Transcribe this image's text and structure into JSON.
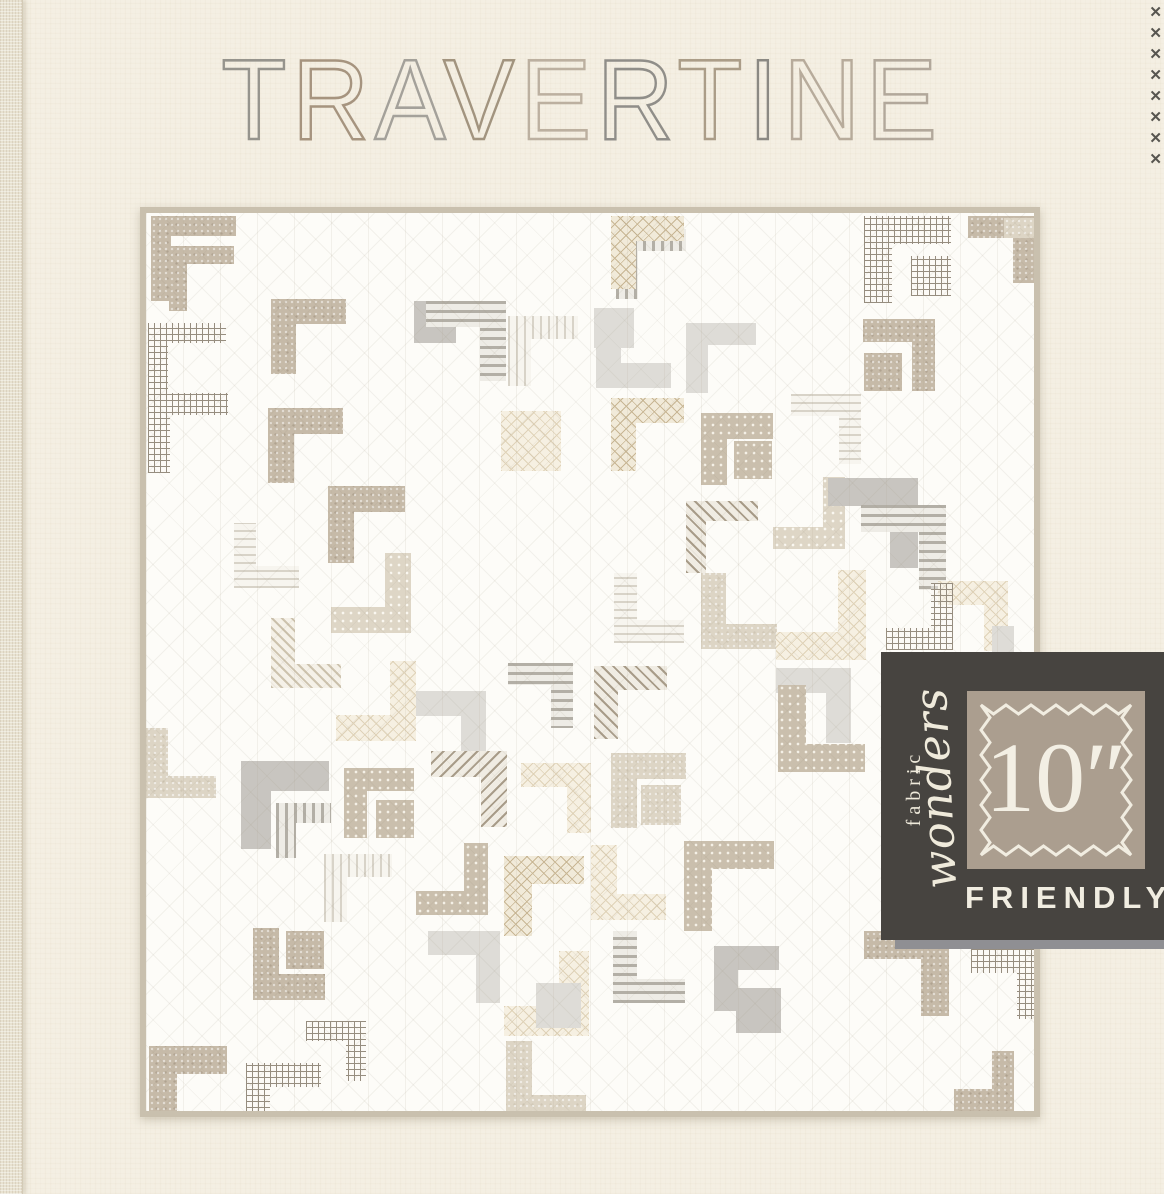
{
  "title": {
    "text": "TRAVERTINE",
    "letters": [
      {
        "ch": "T",
        "color": "#96948d"
      },
      {
        "ch": "R",
        "color": "#a6947f"
      },
      {
        "ch": "A",
        "color": "#a4a19a"
      },
      {
        "ch": "V",
        "color": "#a2947f"
      },
      {
        "ch": "E",
        "color": "#bcb0a0"
      },
      {
        "ch": "R",
        "color": "#908e89"
      },
      {
        "ch": "T",
        "color": "#ab9d88"
      },
      {
        "ch": "I",
        "color": "#8b8983"
      },
      {
        "ch": "N",
        "color": "#b7ab9b"
      },
      {
        "ch": "E",
        "color": "#b2a89b"
      }
    ]
  },
  "badge": {
    "brand_line1": "fabric",
    "brand_line2": "wonders",
    "size_label": "10″",
    "friendly_label": "FRIENDLY",
    "bg_color": "#474440",
    "stamp_color": "#ab9e8f",
    "text_color": "#f1ede1"
  },
  "decor": {
    "x_mark": "✕",
    "x_count": 8,
    "x_color": "#57554f"
  },
  "quilt": {
    "background": "#fdfcf8",
    "binding_color": "#c9c0ae",
    "block_shape": "L-corner",
    "blocks": [
      [
        5,
        3,
        85,
        20,
        0,
        "speckle"
      ],
      [
        23,
        33,
        65,
        18,
        0,
        "speckle"
      ],
      [
        2,
        110,
        78,
        20,
        0,
        "plaid"
      ],
      [
        2,
        180,
        80,
        22,
        0,
        "plaid"
      ],
      [
        122,
        195,
        75,
        26,
        0,
        "speckle"
      ],
      [
        125,
        86,
        75,
        25,
        0,
        "speckle"
      ],
      [
        362,
        103,
        70,
        23,
        0,
        "stripe-lt"
      ],
      [
        470,
        16,
        70,
        22,
        0,
        "stripe"
      ],
      [
        268,
        88,
        42,
        0,
        4,
        "gray"
      ],
      [
        280,
        88,
        80,
        26,
        1,
        "stripe"
      ],
      [
        355,
        198,
        60,
        0,
        4,
        "xhatch-lt"
      ],
      [
        465,
        3,
        73,
        25,
        0,
        "xhatch"
      ],
      [
        448,
        95,
        40,
        0,
        4,
        "gray-lt"
      ],
      [
        450,
        100,
        75,
        25,
        3,
        "gray-lt"
      ],
      [
        540,
        110,
        70,
        22,
        0,
        "gray-lt"
      ],
      [
        465,
        185,
        73,
        25,
        0,
        "xhatch"
      ],
      [
        555,
        200,
        72,
        26,
        0,
        "dots"
      ],
      [
        588,
        228,
        38,
        0,
        4,
        "dots"
      ],
      [
        645,
        181,
        70,
        22,
        1,
        "stripe-lt"
      ],
      [
        627,
        264,
        72,
        22,
        2,
        "dots-lt"
      ],
      [
        540,
        288,
        72,
        20,
        0,
        "diag"
      ],
      [
        718,
        3,
        87,
        28,
        0,
        "plaid"
      ],
      [
        765,
        43,
        40,
        0,
        4,
        "plaid"
      ],
      [
        822,
        3,
        67,
        22,
        1,
        "speckle"
      ],
      [
        717,
        106,
        72,
        23,
        1,
        "speckle"
      ],
      [
        718,
        140,
        38,
        0,
        4,
        "speckle"
      ],
      [
        682,
        265,
        90,
        28,
        1,
        "gray"
      ],
      [
        715,
        292,
        85,
        27,
        1,
        "stripe"
      ],
      [
        792,
        368,
        70,
        24,
        1,
        "xhatch-lt"
      ],
      [
        740,
        370,
        67,
        22,
        2,
        "plaid"
      ],
      [
        468,
        360,
        70,
        23,
        3,
        "stripe-lt"
      ],
      [
        555,
        360,
        76,
        25,
        3,
        "speckle-lt"
      ],
      [
        630,
        357,
        90,
        28,
        2,
        "xhatch-lt"
      ],
      [
        88,
        310,
        65,
        22,
        3,
        "stripe-lt"
      ],
      [
        125,
        405,
        70,
        24,
        3,
        "diag-lt"
      ],
      [
        182,
        273,
        77,
        26,
        0,
        "speckle"
      ],
      [
        185,
        340,
        80,
        26,
        2,
        "dots-lt"
      ],
      [
        0,
        515,
        70,
        22,
        3,
        "speckle-lt"
      ],
      [
        95,
        548,
        88,
        30,
        0,
        "gray"
      ],
      [
        130,
        590,
        55,
        20,
        0,
        "stripe"
      ],
      [
        198,
        555,
        70,
        23,
        0,
        "dots"
      ],
      [
        230,
        587,
        38,
        0,
        4,
        "dots"
      ],
      [
        268,
        478,
        72,
        25,
        1,
        "gray-lt"
      ],
      [
        285,
        538,
        76,
        26,
        1,
        "diag"
      ],
      [
        190,
        448,
        80,
        26,
        2,
        "xhatch-lt"
      ],
      [
        362,
        450,
        65,
        22,
        1,
        "stripe"
      ],
      [
        375,
        550,
        70,
        24,
        1,
        "xhatch-lt"
      ],
      [
        270,
        630,
        72,
        24,
        2,
        "dots"
      ],
      [
        178,
        641,
        68,
        23,
        0,
        "stripe-lt"
      ],
      [
        107,
        715,
        72,
        26,
        3,
        "speckle"
      ],
      [
        140,
        718,
        38,
        0,
        4,
        "speckle"
      ],
      [
        282,
        718,
        72,
        24,
        1,
        "gray-lt"
      ],
      [
        358,
        643,
        80,
        28,
        0,
        "xhatch"
      ],
      [
        358,
        738,
        85,
        30,
        2,
        "xhatch-lt"
      ],
      [
        390,
        770,
        45,
        0,
        4,
        "gray-lt"
      ],
      [
        360,
        828,
        80,
        26,
        3,
        "speckle-lt"
      ],
      [
        3,
        833,
        78,
        28,
        0,
        "speckle"
      ],
      [
        100,
        850,
        75,
        24,
        0,
        "plaid"
      ],
      [
        160,
        808,
        60,
        20,
        1,
        "plaid"
      ],
      [
        448,
        453,
        73,
        24,
        0,
        "diag"
      ],
      [
        465,
        540,
        75,
        26,
        0,
        "speckle-lt"
      ],
      [
        495,
        572,
        40,
        0,
        4,
        "speckle-lt"
      ],
      [
        445,
        632,
        75,
        26,
        3,
        "xhatch-lt"
      ],
      [
        538,
        628,
        90,
        28,
        0,
        "dots"
      ],
      [
        630,
        455,
        75,
        25,
        1,
        "gray-lt"
      ],
      [
        632,
        472,
        87,
        28,
        3,
        "dots"
      ],
      [
        467,
        718,
        72,
        24,
        3,
        "stripe"
      ],
      [
        568,
        733,
        65,
        24,
        0,
        "gray"
      ],
      [
        590,
        775,
        45,
        0,
        4,
        "gray"
      ],
      [
        718,
        718,
        85,
        28,
        1,
        "speckle"
      ],
      [
        825,
        736,
        70,
        24,
        1,
        "plaid"
      ],
      [
        808,
        838,
        60,
        22,
        2,
        "speckle"
      ],
      [
        808,
        413,
        60,
        22,
        2,
        "gray-lt"
      ],
      [
        858,
        5,
        60,
        20,
        1,
        "speckle-lt"
      ]
    ]
  }
}
